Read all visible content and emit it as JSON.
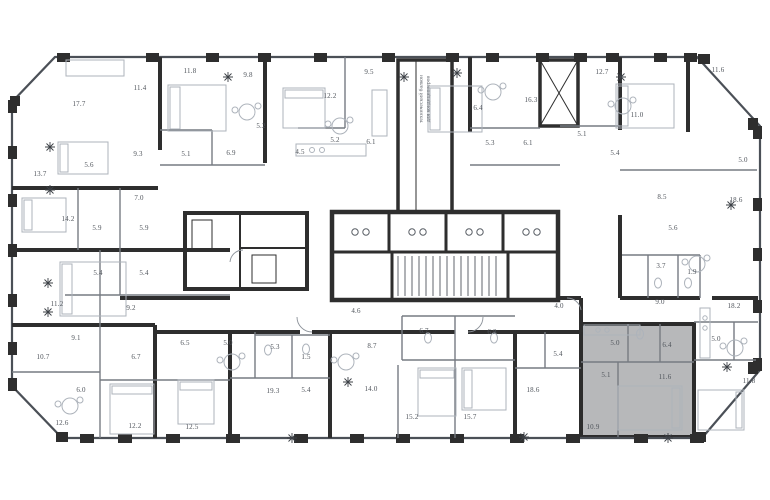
{
  "meta": {
    "type": "residential-floor-plan",
    "area_units": "m2"
  },
  "highlight": {
    "color": "#b7b8ba",
    "description": "selected apartment",
    "unit_room_areas": [
      "5.0",
      "6.4",
      "5.1",
      "11.6",
      "10.9"
    ]
  },
  "annotations": {
    "technical_balcony_line1": "технический балкон",
    "technical_balcony_line2": "для кондиционеров"
  },
  "rooms": [
    {
      "x": 79,
      "y": 104,
      "area": "17.7"
    },
    {
      "x": 140,
      "y": 88,
      "area": "11.4"
    },
    {
      "x": 190,
      "y": 71,
      "area": "11.8"
    },
    {
      "x": 248,
      "y": 75,
      "area": "9.8"
    },
    {
      "x": 261,
      "y": 126,
      "area": "5.2"
    },
    {
      "x": 330,
      "y": 96,
      "area": "12.2"
    },
    {
      "x": 369,
      "y": 72,
      "area": "9.5"
    },
    {
      "x": 40,
      "y": 174,
      "area": "13.7"
    },
    {
      "x": 89,
      "y": 165,
      "area": "5.6"
    },
    {
      "x": 138,
      "y": 154,
      "area": "9.3"
    },
    {
      "x": 186,
      "y": 154,
      "area": "5.1"
    },
    {
      "x": 231,
      "y": 153,
      "area": "6.9"
    },
    {
      "x": 300,
      "y": 152,
      "area": "4.5"
    },
    {
      "x": 335,
      "y": 140,
      "area": "5.2"
    },
    {
      "x": 371,
      "y": 142,
      "area": "6.1"
    },
    {
      "x": 139,
      "y": 198,
      "area": "7.0"
    },
    {
      "x": 68,
      "y": 219,
      "area": "14.2"
    },
    {
      "x": 97,
      "y": 228,
      "area": "5.9"
    },
    {
      "x": 144,
      "y": 228,
      "area": "5.9"
    },
    {
      "x": 98,
      "y": 273,
      "area": "5.4"
    },
    {
      "x": 144,
      "y": 273,
      "area": "5.4"
    },
    {
      "x": 57,
      "y": 304,
      "area": "11.2"
    },
    {
      "x": 131,
      "y": 308,
      "area": "9.2"
    },
    {
      "x": 76,
      "y": 338,
      "area": "9.1"
    },
    {
      "x": 43,
      "y": 357,
      "area": "10.7"
    },
    {
      "x": 136,
      "y": 357,
      "area": "6.7"
    },
    {
      "x": 81,
      "y": 390,
      "area": "6.0"
    },
    {
      "x": 62,
      "y": 423,
      "area": "12.6"
    },
    {
      "x": 135,
      "y": 426,
      "area": "12.2"
    },
    {
      "x": 192,
      "y": 427,
      "area": "12.5"
    },
    {
      "x": 185,
      "y": 343,
      "area": "6.5"
    },
    {
      "x": 228,
      "y": 343,
      "area": "5.0"
    },
    {
      "x": 275,
      "y": 347,
      "area": "5.3"
    },
    {
      "x": 306,
      "y": 357,
      "area": "1.5"
    },
    {
      "x": 273,
      "y": 391,
      "area": "19.3"
    },
    {
      "x": 306,
      "y": 390,
      "area": "5.4"
    },
    {
      "x": 356,
      "y": 311,
      "area": "4.6"
    },
    {
      "x": 372,
      "y": 346,
      "area": "8.7"
    },
    {
      "x": 371,
      "y": 389,
      "area": "14.0"
    },
    {
      "x": 424,
      "y": 331,
      "area": "6.7"
    },
    {
      "x": 492,
      "y": 332,
      "area": "6.8"
    },
    {
      "x": 412,
      "y": 417,
      "area": "15.2"
    },
    {
      "x": 470,
      "y": 417,
      "area": "15.7"
    },
    {
      "x": 478,
      "y": 108,
      "area": "6.4"
    },
    {
      "x": 531,
      "y": 100,
      "area": "16.3"
    },
    {
      "x": 490,
      "y": 143,
      "area": "5.3"
    },
    {
      "x": 528,
      "y": 143,
      "area": "6.1"
    },
    {
      "x": 602,
      "y": 72,
      "area": "12.7"
    },
    {
      "x": 582,
      "y": 134,
      "area": "5.1"
    },
    {
      "x": 615,
      "y": 153,
      "area": "5.4"
    },
    {
      "x": 637,
      "y": 115,
      "area": "11.0"
    },
    {
      "x": 718,
      "y": 70,
      "area": "11.6"
    },
    {
      "x": 743,
      "y": 160,
      "area": "5.0"
    },
    {
      "x": 662,
      "y": 197,
      "area": "8.5"
    },
    {
      "x": 736,
      "y": 200,
      "area": "18.6"
    },
    {
      "x": 673,
      "y": 228,
      "area": "5.6"
    },
    {
      "x": 661,
      "y": 266,
      "area": "3.7"
    },
    {
      "x": 692,
      "y": 272,
      "area": "1.9"
    },
    {
      "x": 660,
      "y": 302,
      "area": "9.0"
    },
    {
      "x": 734,
      "y": 306,
      "area": "18.2"
    },
    {
      "x": 559,
      "y": 306,
      "area": "4.0"
    },
    {
      "x": 558,
      "y": 354,
      "area": "5.4"
    },
    {
      "x": 533,
      "y": 390,
      "area": "18.6"
    },
    {
      "x": 716,
      "y": 339,
      "area": "5.0"
    },
    {
      "x": 749,
      "y": 381,
      "area": "11.8"
    },
    {
      "x": 615,
      "y": 343,
      "area": "5.0"
    },
    {
      "x": 667,
      "y": 345,
      "area": "6.4"
    },
    {
      "x": 606,
      "y": 375,
      "area": "5.1"
    },
    {
      "x": 665,
      "y": 377,
      "area": "11.6"
    },
    {
      "x": 593,
      "y": 427,
      "area": "10.9"
    }
  ]
}
